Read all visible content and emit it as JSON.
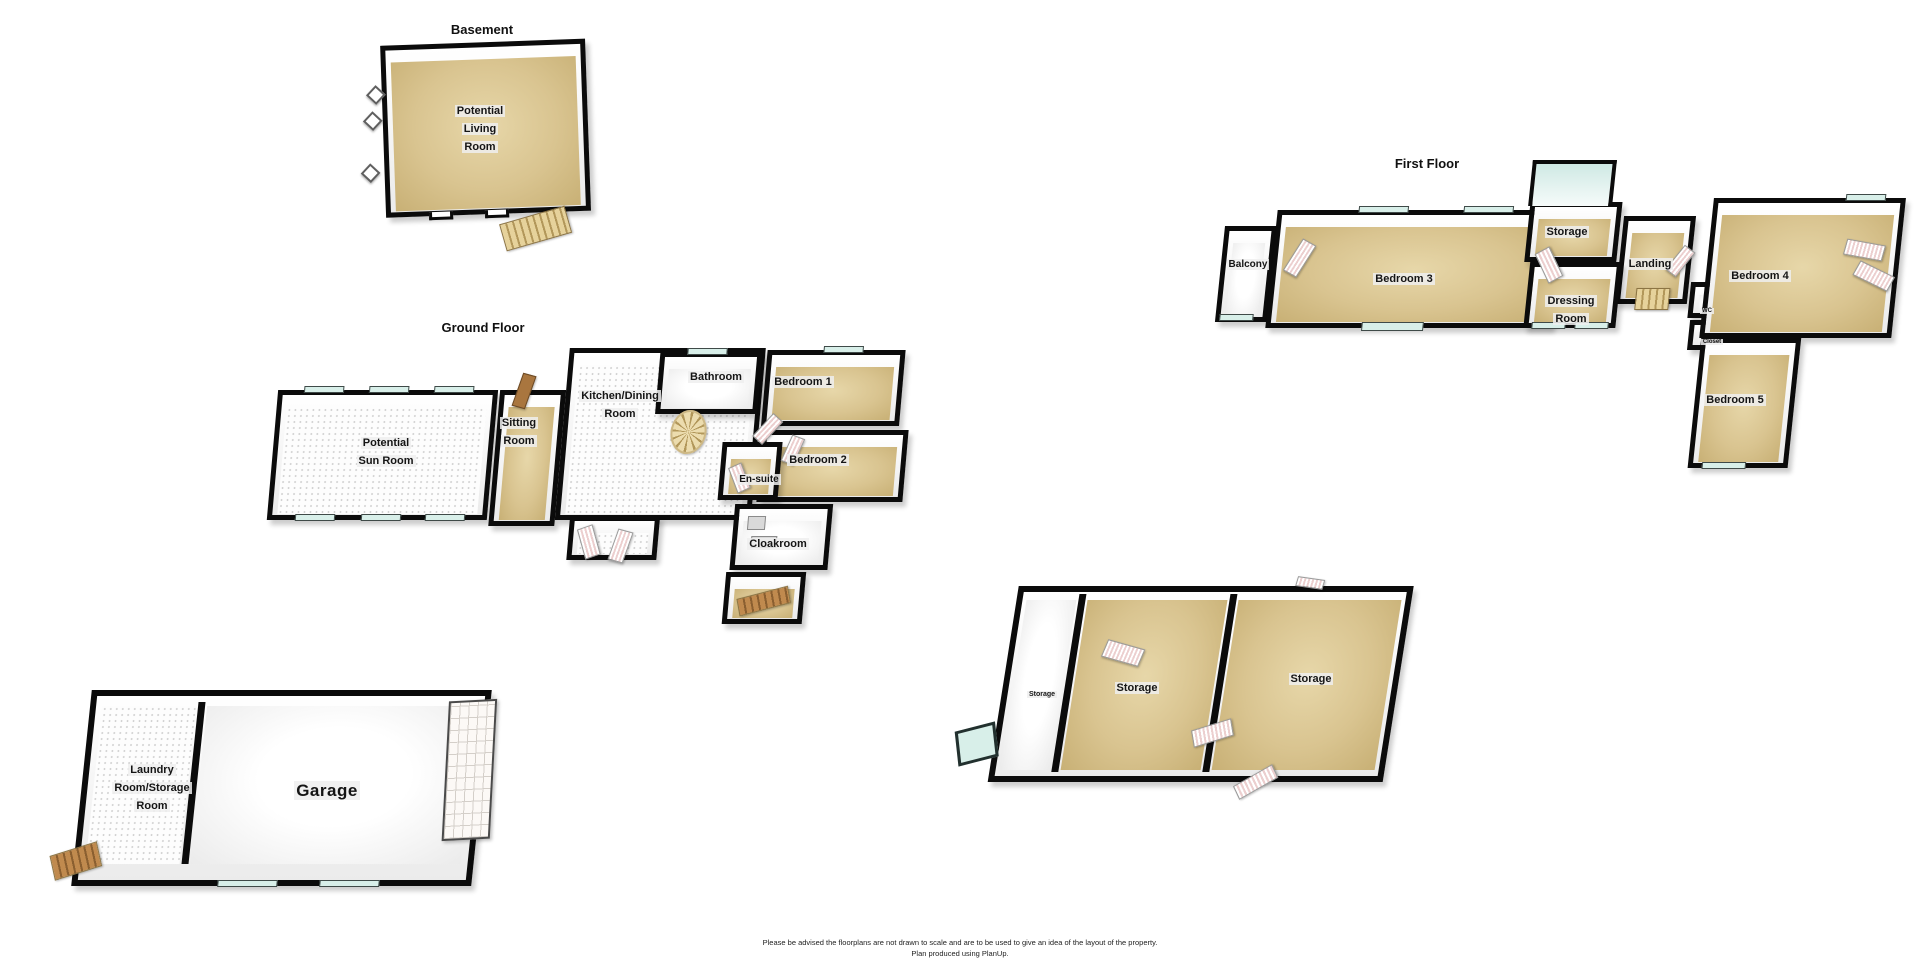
{
  "titles": {
    "basement": "Basement",
    "ground": "Ground Floor",
    "first": "First Floor"
  },
  "rooms": {
    "potential_living_room": "Potential Living Room",
    "potential_sun_room": "Potential Sun Room",
    "sitting_room": "Sitting Room",
    "kitchen_dining": "Kitchen/Dining Room",
    "bathroom": "Bathroom",
    "bedroom_1": "Bedroom 1",
    "bedroom_2": "Bedroom 2",
    "en_suite": "En-suite",
    "cloakroom": "Cloakroom",
    "balcony": "Balcony",
    "bedroom_3": "Bedroom 3",
    "storage_first": "Storage",
    "landing": "Landing",
    "dressing_room": "Dressing Room",
    "wc": "WC",
    "closet": "Closet",
    "bedroom_4": "Bedroom 4",
    "bedroom_5": "Bedroom 5",
    "laundry_storage": "Laundry Room/Storage Room",
    "garage": "Garage",
    "storage_out_small": "Storage",
    "storage_out_mid": "Storage",
    "storage_out_right": "Storage"
  },
  "footer": {
    "disclaimer_line1": "Please be advised the floorplans are not drawn to scale and are to be used to give an idea of the layout of the property.",
    "disclaimer_line2": "Plan produced using PlanUp."
  },
  "colors": {
    "wall": "#0b0b0b",
    "floor_tan": "#d9c490",
    "floor_tan_light": "#e7d7a9",
    "window": "#d8efe9",
    "door_stripe": "#eccfcf",
    "stair": "#e6d29b"
  }
}
